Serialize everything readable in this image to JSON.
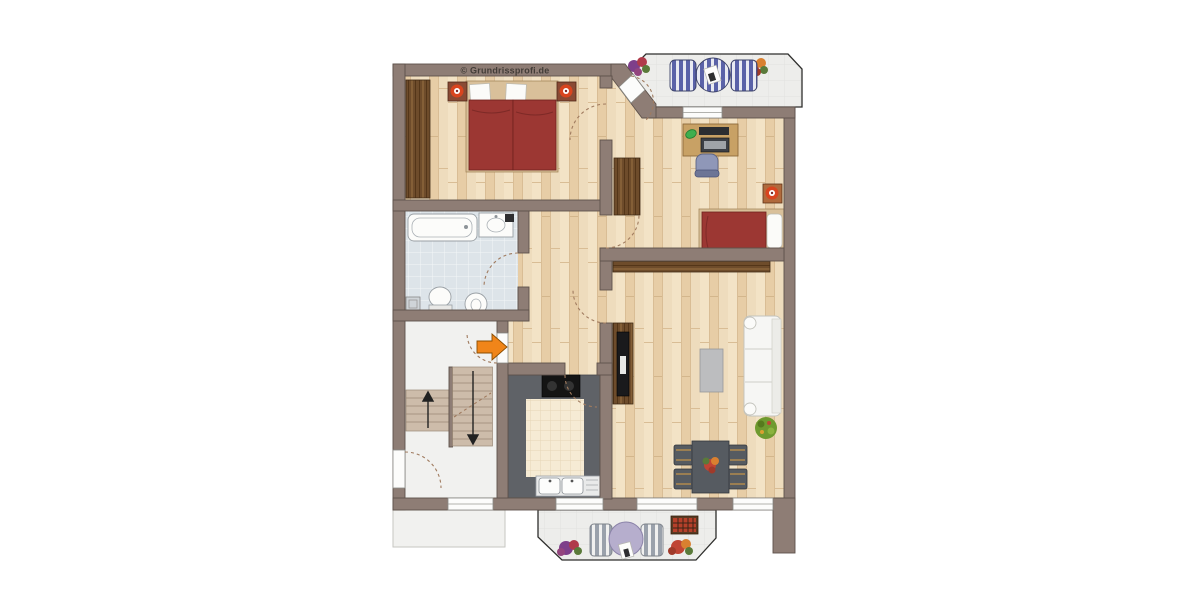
{
  "copyright": "© Grundrissprofi.de",
  "palette": {
    "wall": "#8e7d75",
    "wallOutline": "#5e524b",
    "doorArc": "#a07b5f",
    "counter": "#5f6267",
    "bedRed": "#9c3733",
    "sofa": "#f6f6f4",
    "accentOrange": "#f08519",
    "tableBlue": "#5a62a8",
    "tableLavender": "#b6aecd",
    "stairFloor": "#f1f1ef",
    "diningDark": "#565b61",
    "coffeeGray": "#bcbdbf",
    "plantGreen": "#6f9a2f",
    "lampOrange": "#d8451f",
    "copyrightColor": "#433d38"
  },
  "icons": {
    "entry_arrow": "right-arrow",
    "stair_up": "up-arrow",
    "stair_down": "down-arrow"
  }
}
